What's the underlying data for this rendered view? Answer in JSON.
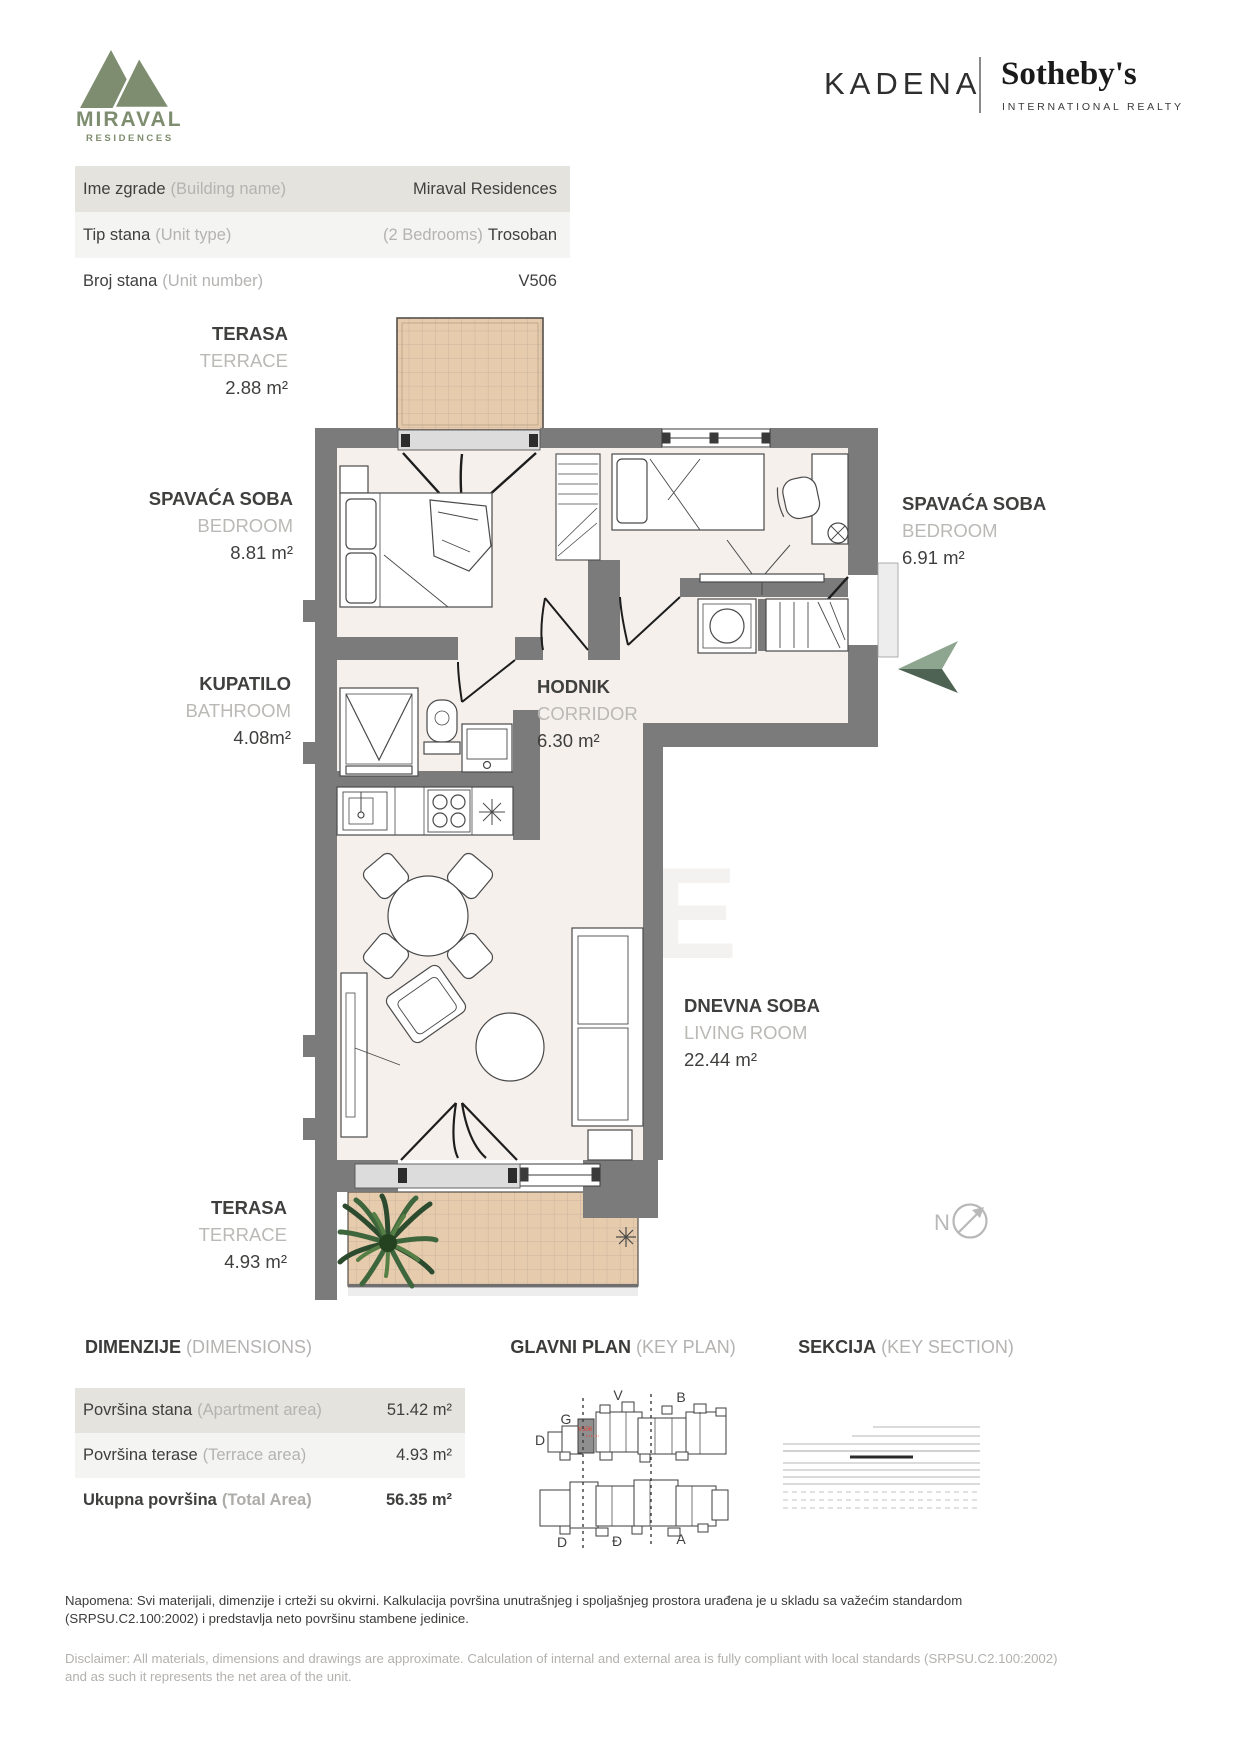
{
  "brand": {
    "logo_title": "MIRAVAL",
    "logo_sub": "RESIDENCES",
    "agency": "KADENA",
    "realty": "Sotheby's",
    "realty_sub": "INTERNATIONAL REALTY"
  },
  "colors": {
    "accent_green": "#7e8d6f",
    "wall_gray": "#7b7b7b",
    "terrace_tan": "#e6cbad",
    "unit_red": "#e8372c"
  },
  "info_rows": [
    {
      "label": "Ime zgrade",
      "note": "(Building name)",
      "value_note": "",
      "value": "Miraval Residences"
    },
    {
      "label": "Tip stana",
      "note": "(Unit type)",
      "value_note": "(2 Bedrooms)",
      "value": "Trosoban"
    },
    {
      "label": "Broj stana",
      "note": "(Unit number)",
      "value_note": "",
      "value": "V506"
    }
  ],
  "rooms": [
    {
      "sr": "TERASA",
      "en": "TERRACE",
      "area": "2.88 m²"
    },
    {
      "sr": "SPAVAĆA SOBA",
      "en": "BEDROOM",
      "area": "8.81 m²"
    },
    {
      "sr": "SPAVAĆA SOBA",
      "en": "BEDROOM",
      "area": "6.91 m²"
    },
    {
      "sr": "KUPATILO",
      "en": "BATHROOM",
      "area": "4.08m²"
    },
    {
      "sr": "HODNIK",
      "en": "CORRIDOR",
      "area": "6.30 m²"
    },
    {
      "sr": "DNEVNA SOBA",
      "en": "LIVING ROOM",
      "area": "22.44 m²"
    },
    {
      "sr": "TERASA",
      "en": "TERRACE",
      "area": "4.93 m²"
    }
  ],
  "dimensions": {
    "title": "DIMENZIJE",
    "title_note": "(DIMENSIONS)",
    "rows": [
      {
        "label": "Površina stana",
        "note": "(Apartment area)",
        "value": "51.42 m²"
      },
      {
        "label": "Površina terase",
        "note": "(Terrace area)",
        "value": "4.93 m²"
      },
      {
        "label": "Ukupna površina",
        "note": "(Total Area)",
        "value": "56.35 m²"
      }
    ]
  },
  "keyplan": {
    "title": "GLAVNI PLAN",
    "title_note": "(KEY PLAN)",
    "unit_label": "V506",
    "letters": [
      "D",
      "G",
      "V",
      "B",
      "D",
      "Đ",
      "A"
    ]
  },
  "section": {
    "title": "SEKCIJA",
    "title_note": "(KEY SECTION)"
  },
  "compass": {
    "label": "N"
  },
  "watermark": {
    "line1": "BA",
    "line2": "NE"
  },
  "disclaimer": {
    "sr": "Napomena: Svi materijali, dimenzije i crteži su okvirni. Kalkulacija površina unutrašnjeg i spoljašnjeg prostora urađena je u skladu sa važećim standardom (SRPSU.C2.100:2002) i predstavlja neto površinu stambene jedinice.",
    "en": "Disclaimer: All materials, dimensions and drawings are approximate. Calculation of internal and external area is fully compliant with local standards (SRPSU.C2.100:2002) and as such it represents the net area of the unit."
  }
}
